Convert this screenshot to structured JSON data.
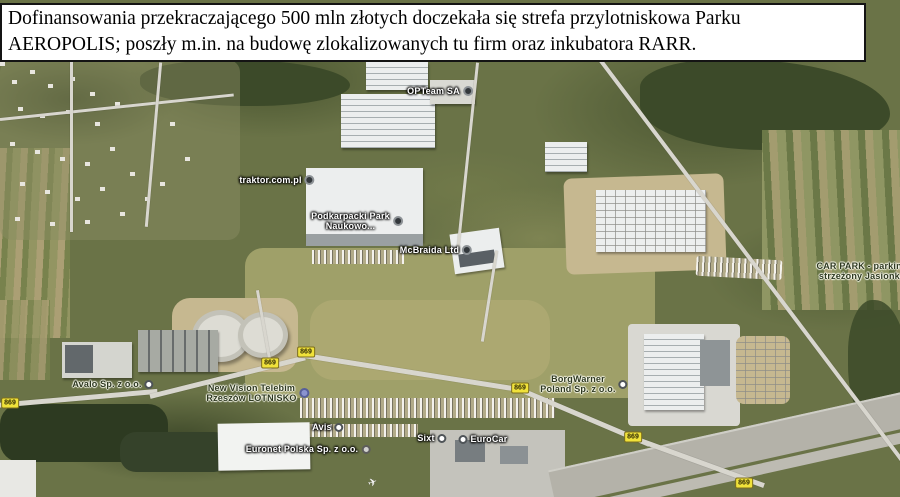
{
  "banner": {
    "line1": "Dofinansowania przekraczającego 500 mln złotych doczekała się strefa przylotniskowa Parku",
    "line2": "AEROPOLIS; poszły m.in. na budowę zlokalizowanych tu firm oraz inkubatora RARR."
  },
  "map": {
    "type": "satellite-imagery",
    "labels": [
      {
        "id": "opteam",
        "lines": [
          "OPTeam SA"
        ],
        "x": 440,
        "y": 91,
        "tone": "light",
        "marker": "dark",
        "marker_side": "right"
      },
      {
        "id": "traktor",
        "lines": [
          "traktor.com.pl"
        ],
        "x": 277,
        "y": 180,
        "tone": "light",
        "marker": "dark",
        "marker_side": "right"
      },
      {
        "id": "podkarpacki",
        "lines": [
          "Podkarpacki Park",
          "Naukowo..."
        ],
        "x": 357,
        "y": 221,
        "tone": "light",
        "marker": "dark",
        "marker_side": "right"
      },
      {
        "id": "mcbraida",
        "lines": [
          "McBraida Ltd"
        ],
        "x": 436,
        "y": 250,
        "tone": "light",
        "marker": "dark",
        "marker_side": "right"
      },
      {
        "id": "carpark",
        "lines": [
          "CAR PARK - parking",
          "strzeżony Jasionka"
        ],
        "x": 862,
        "y": 271,
        "tone": "dark",
        "marker": "none",
        "marker_side": "right"
      },
      {
        "id": "avalo",
        "lines": [
          "Avalo Sp. z o.o."
        ],
        "x": 113,
        "y": 384,
        "tone": "dark",
        "marker": "white",
        "marker_side": "right"
      },
      {
        "id": "newvision",
        "lines": [
          "New Vision Telebim",
          "Rzeszów LOTNISKO"
        ],
        "x": 258,
        "y": 393,
        "tone": "dark",
        "marker": "blue",
        "marker_side": "right"
      },
      {
        "id": "borgwarner",
        "lines": [
          "BorgWarner",
          "Poland Sp. z o.o."
        ],
        "x": 584,
        "y": 384,
        "tone": "dark",
        "marker": "white",
        "marker_side": "right"
      },
      {
        "id": "avis",
        "lines": [
          "Avis"
        ],
        "x": 328,
        "y": 427,
        "tone": "light",
        "marker": "white",
        "marker_side": "right"
      },
      {
        "id": "euronet",
        "lines": [
          "Euronet Polska Sp. z o.o."
        ],
        "x": 308,
        "y": 449,
        "tone": "light",
        "marker": "gray",
        "marker_side": "right"
      },
      {
        "id": "sixt",
        "lines": [
          "Sixt"
        ],
        "x": 432,
        "y": 438,
        "tone": "light",
        "marker": "white",
        "marker_side": "right"
      },
      {
        "id": "eurocar",
        "lines": [
          "EuroCar"
        ],
        "x": 483,
        "y": 439,
        "tone": "light",
        "marker": "white",
        "marker_side": "left"
      }
    ],
    "road_badges": [
      {
        "text": "869",
        "x": 10,
        "y": 403
      },
      {
        "text": "869",
        "x": 270,
        "y": 363
      },
      {
        "text": "869",
        "x": 306,
        "y": 352
      },
      {
        "text": "869",
        "x": 520,
        "y": 388
      },
      {
        "text": "869",
        "x": 633,
        "y": 437
      },
      {
        "text": "869",
        "x": 744,
        "y": 483
      }
    ],
    "aircraft_glyph": "✈"
  },
  "colors": {
    "banner_background": "#ffffff",
    "banner_border": "#141414",
    "badge_background": "#f0e23a",
    "badge_border": "#7c6e1d",
    "label_light": "#ffffff",
    "label_dark": "#2e3920"
  }
}
